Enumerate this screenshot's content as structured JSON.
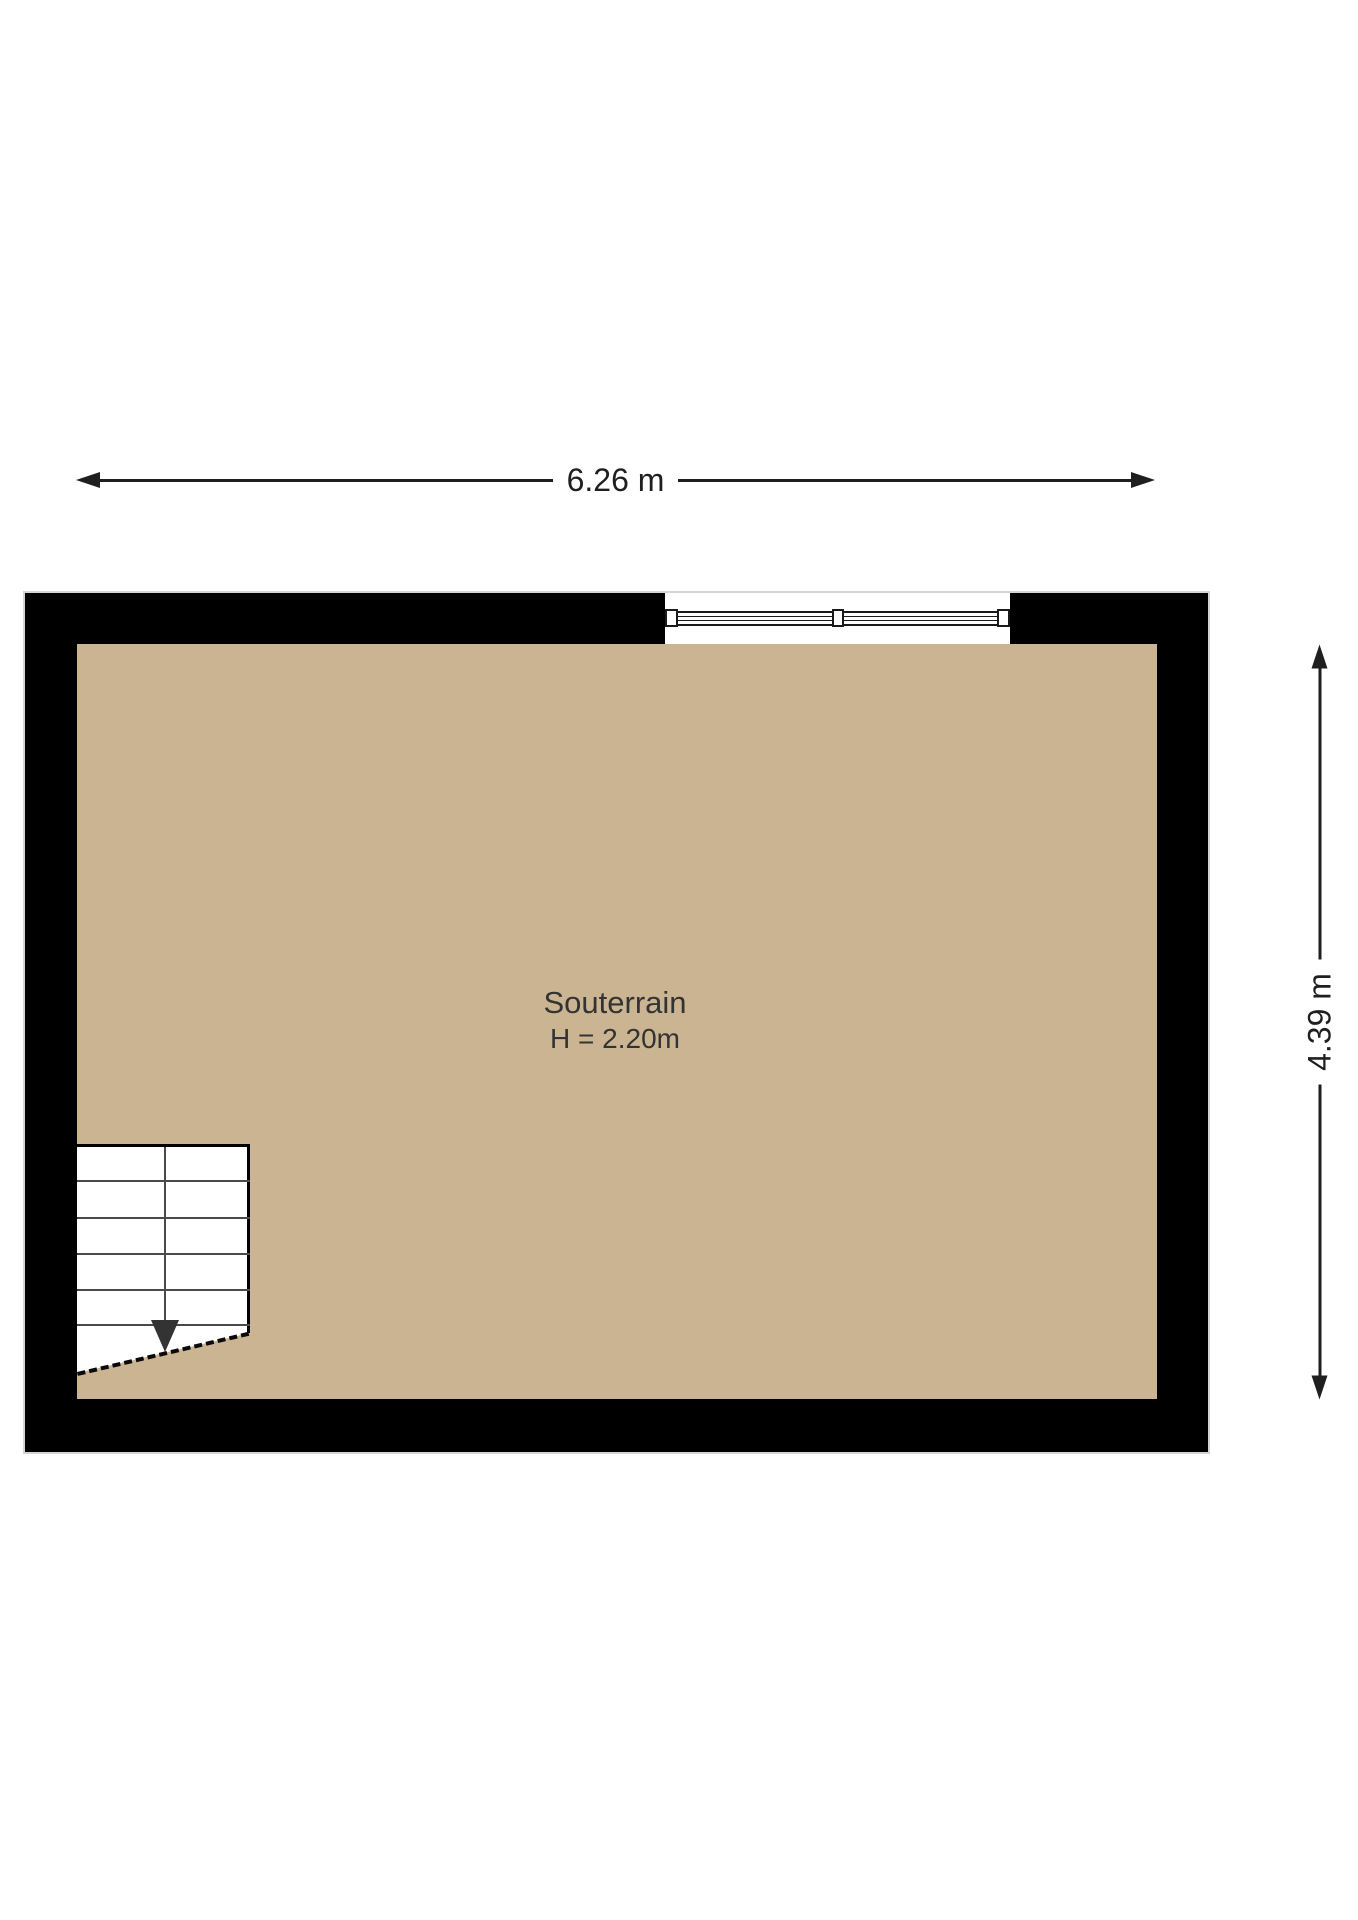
{
  "plan": {
    "room": {
      "name": "Souterrain",
      "ceiling_height": "H = 2.20m"
    },
    "dimensions": {
      "width": "6.26 m",
      "height": "4.39 m"
    },
    "colors": {
      "floor": "#cbb492",
      "wall": "#000000",
      "dimension_line": "#1f1f1f"
    },
    "stairs": {
      "tread_lines": 5,
      "direction_arrow": "down"
    },
    "window": {
      "wall": "top",
      "panes": 2
    }
  }
}
